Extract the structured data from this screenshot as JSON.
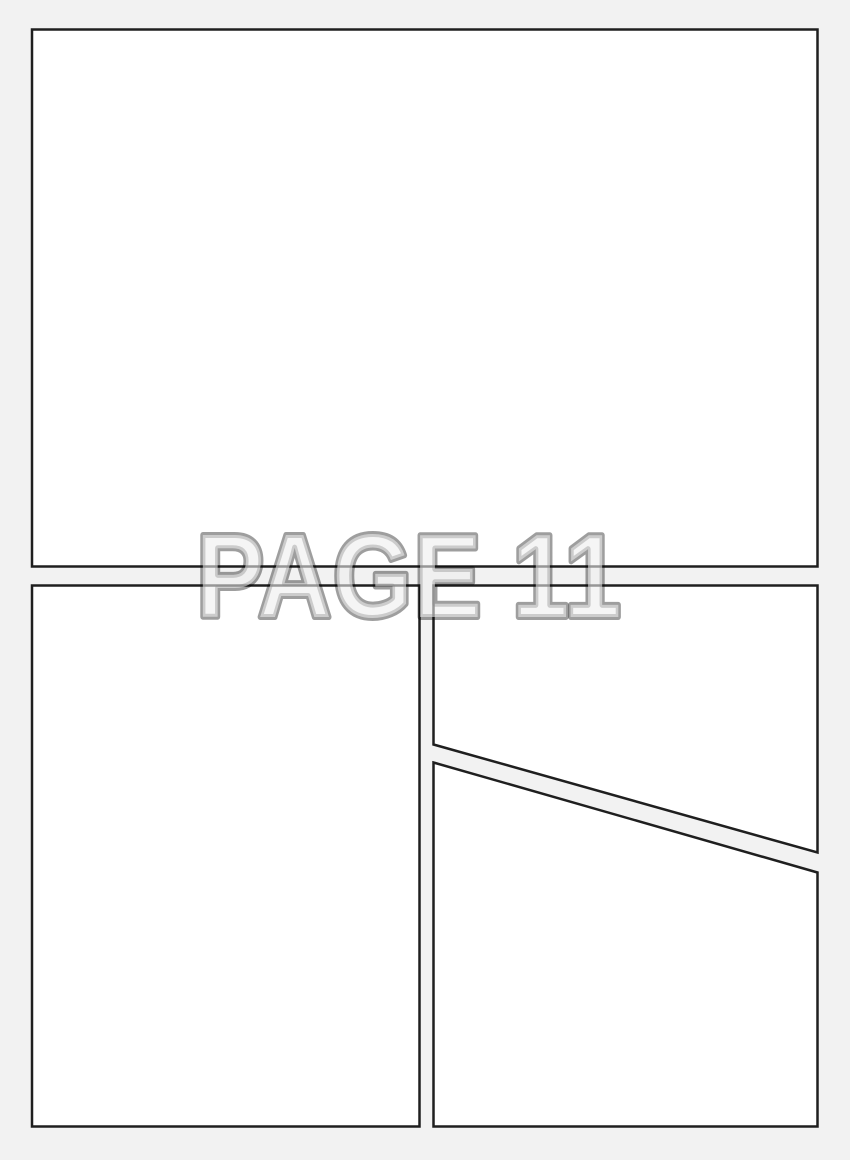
{
  "page_label": "PAGE 11",
  "panel_count": 4,
  "colors": {
    "background": "#f2f2f2",
    "panel_fill": "#ffffff",
    "panel_border": "#1f1f1f",
    "label_fill": "#ededed",
    "label_stroke": "#000000"
  }
}
